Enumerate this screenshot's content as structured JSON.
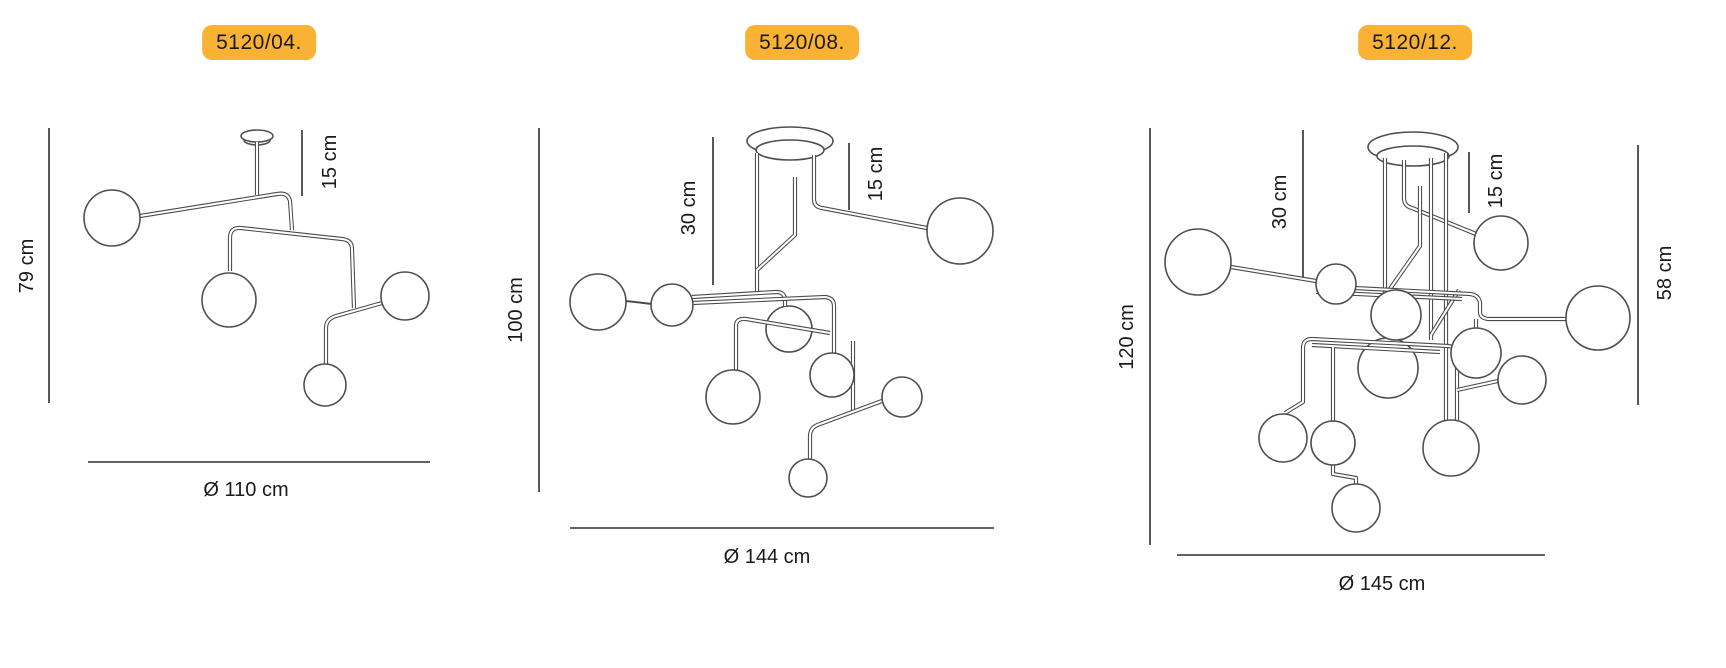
{
  "sheet_title": "Chandelier dimension diagrams",
  "colors": {
    "background": "#ffffff",
    "badge_background": "#f9b233",
    "badge_text": "#1a1a1a",
    "line": "#4a4a4a",
    "dimension_text": "#1a1a1a"
  },
  "panels": [
    {
      "code": "5120/04.",
      "height": "79 cm",
      "ceiling_drop": "15 cm",
      "diameter": "Ø 110 cm",
      "globe_count": 4
    },
    {
      "code": "5120/08.",
      "height": "100 cm",
      "rod_length": "30 cm",
      "ceiling_drop": "15 cm",
      "diameter": "Ø 144 cm",
      "globe_count": 8
    },
    {
      "code": "5120/12.",
      "height": "120 cm",
      "rod_length": "30 cm",
      "ceiling_drop": "15 cm",
      "side_height": "58 cm",
      "diameter": "Ø 145 cm",
      "globe_count": 12
    }
  ]
}
